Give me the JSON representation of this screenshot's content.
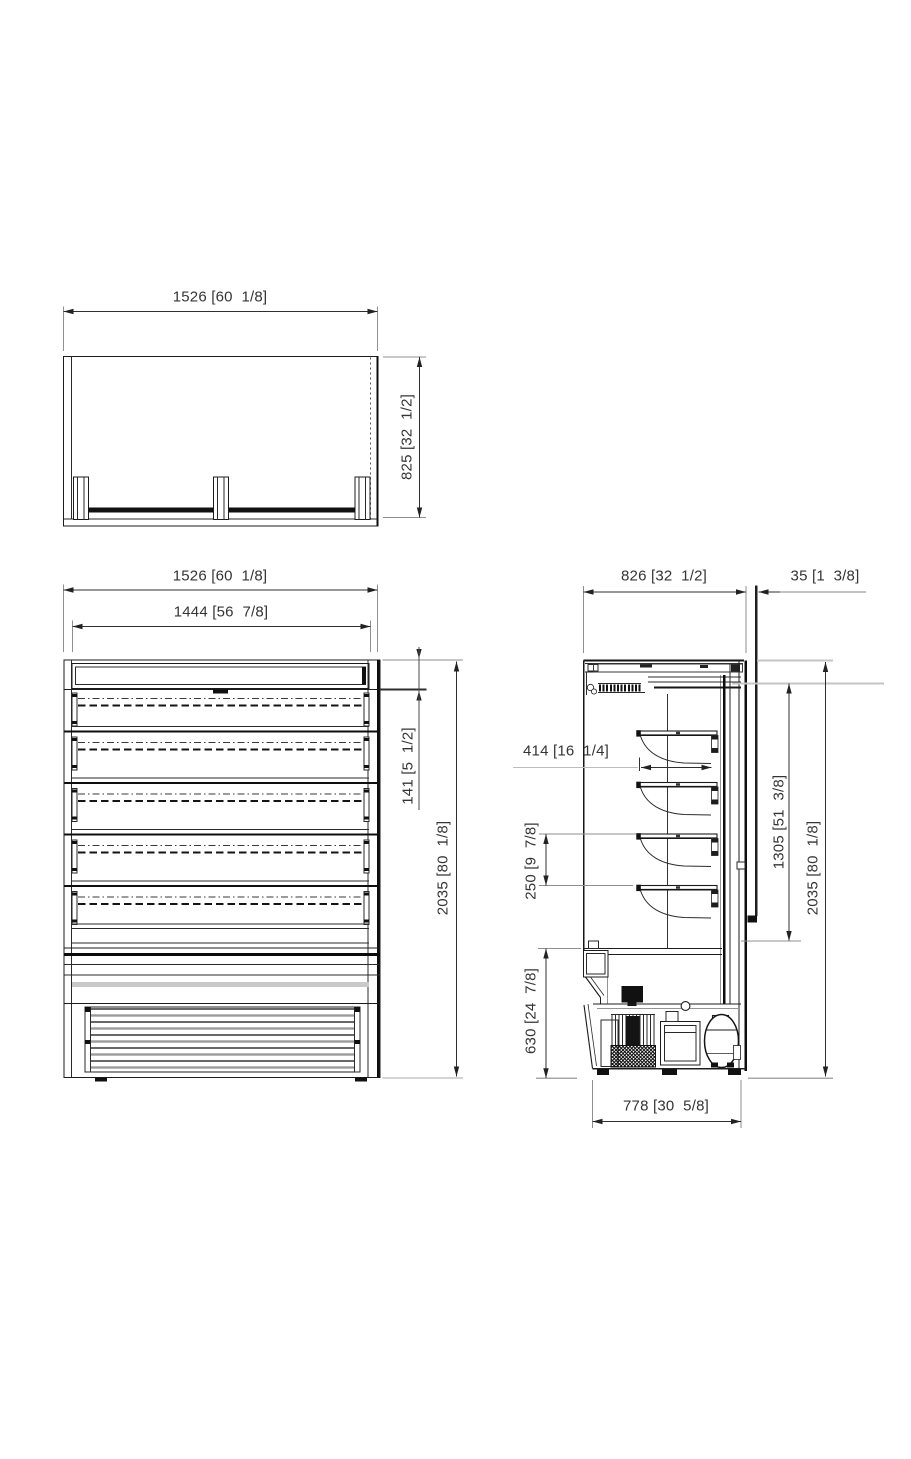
{
  "drawing": {
    "units_format": "mm [in]",
    "ink_color": "#1c1c1c",
    "plan_view": {
      "width": {
        "mm": "1526",
        "in": "60  1/8",
        "label": "1526 [60  1/8]"
      },
      "depth": {
        "mm": "825",
        "in": "32  1/2",
        "label": "825 [32  1/2]"
      }
    },
    "front_view": {
      "overall_width": {
        "mm": "1526",
        "in": "60  1/8",
        "label": "1526 [60  1/8]"
      },
      "interior_width": {
        "mm": "1444",
        "in": "56  7/8",
        "label": "1444 [56  7/8]"
      },
      "canopy_height": {
        "mm": "141",
        "in": "5  1/2",
        "label": "141 [5  1/2]"
      },
      "overall_height": {
        "mm": "2035",
        "in": "80  1/8",
        "label": "2035 [80  1/8]"
      },
      "shelf_levels": 5
    },
    "side_view": {
      "depth": {
        "mm": "826",
        "in": "32  1/2",
        "label": "826 [32  1/2]"
      },
      "rear_gap": {
        "mm": "35",
        "in": "1  3/8",
        "label": "35 [1  3/8]"
      },
      "shelf_depth": {
        "mm": "414",
        "in": "16  1/4",
        "label": "414 [16  1/4]"
      },
      "shelf_spacing": {
        "mm": "250",
        "in": "9  7/8",
        "label": "250 [9  7/8]"
      },
      "opening_height": {
        "mm": "1305",
        "in": "51  3/8",
        "label": "1305 [51  3/8]"
      },
      "overall_height": {
        "mm": "2035",
        "in": "80  1/8",
        "label": "2035 [80  1/8]"
      },
      "base_height": {
        "mm": "630",
        "in": "24  7/8",
        "label": "630 [24  7/8]"
      },
      "base_depth": {
        "mm": "778",
        "in": "30  5/8",
        "label": "778 [30  5/8]"
      },
      "shelf_levels": 4
    }
  }
}
